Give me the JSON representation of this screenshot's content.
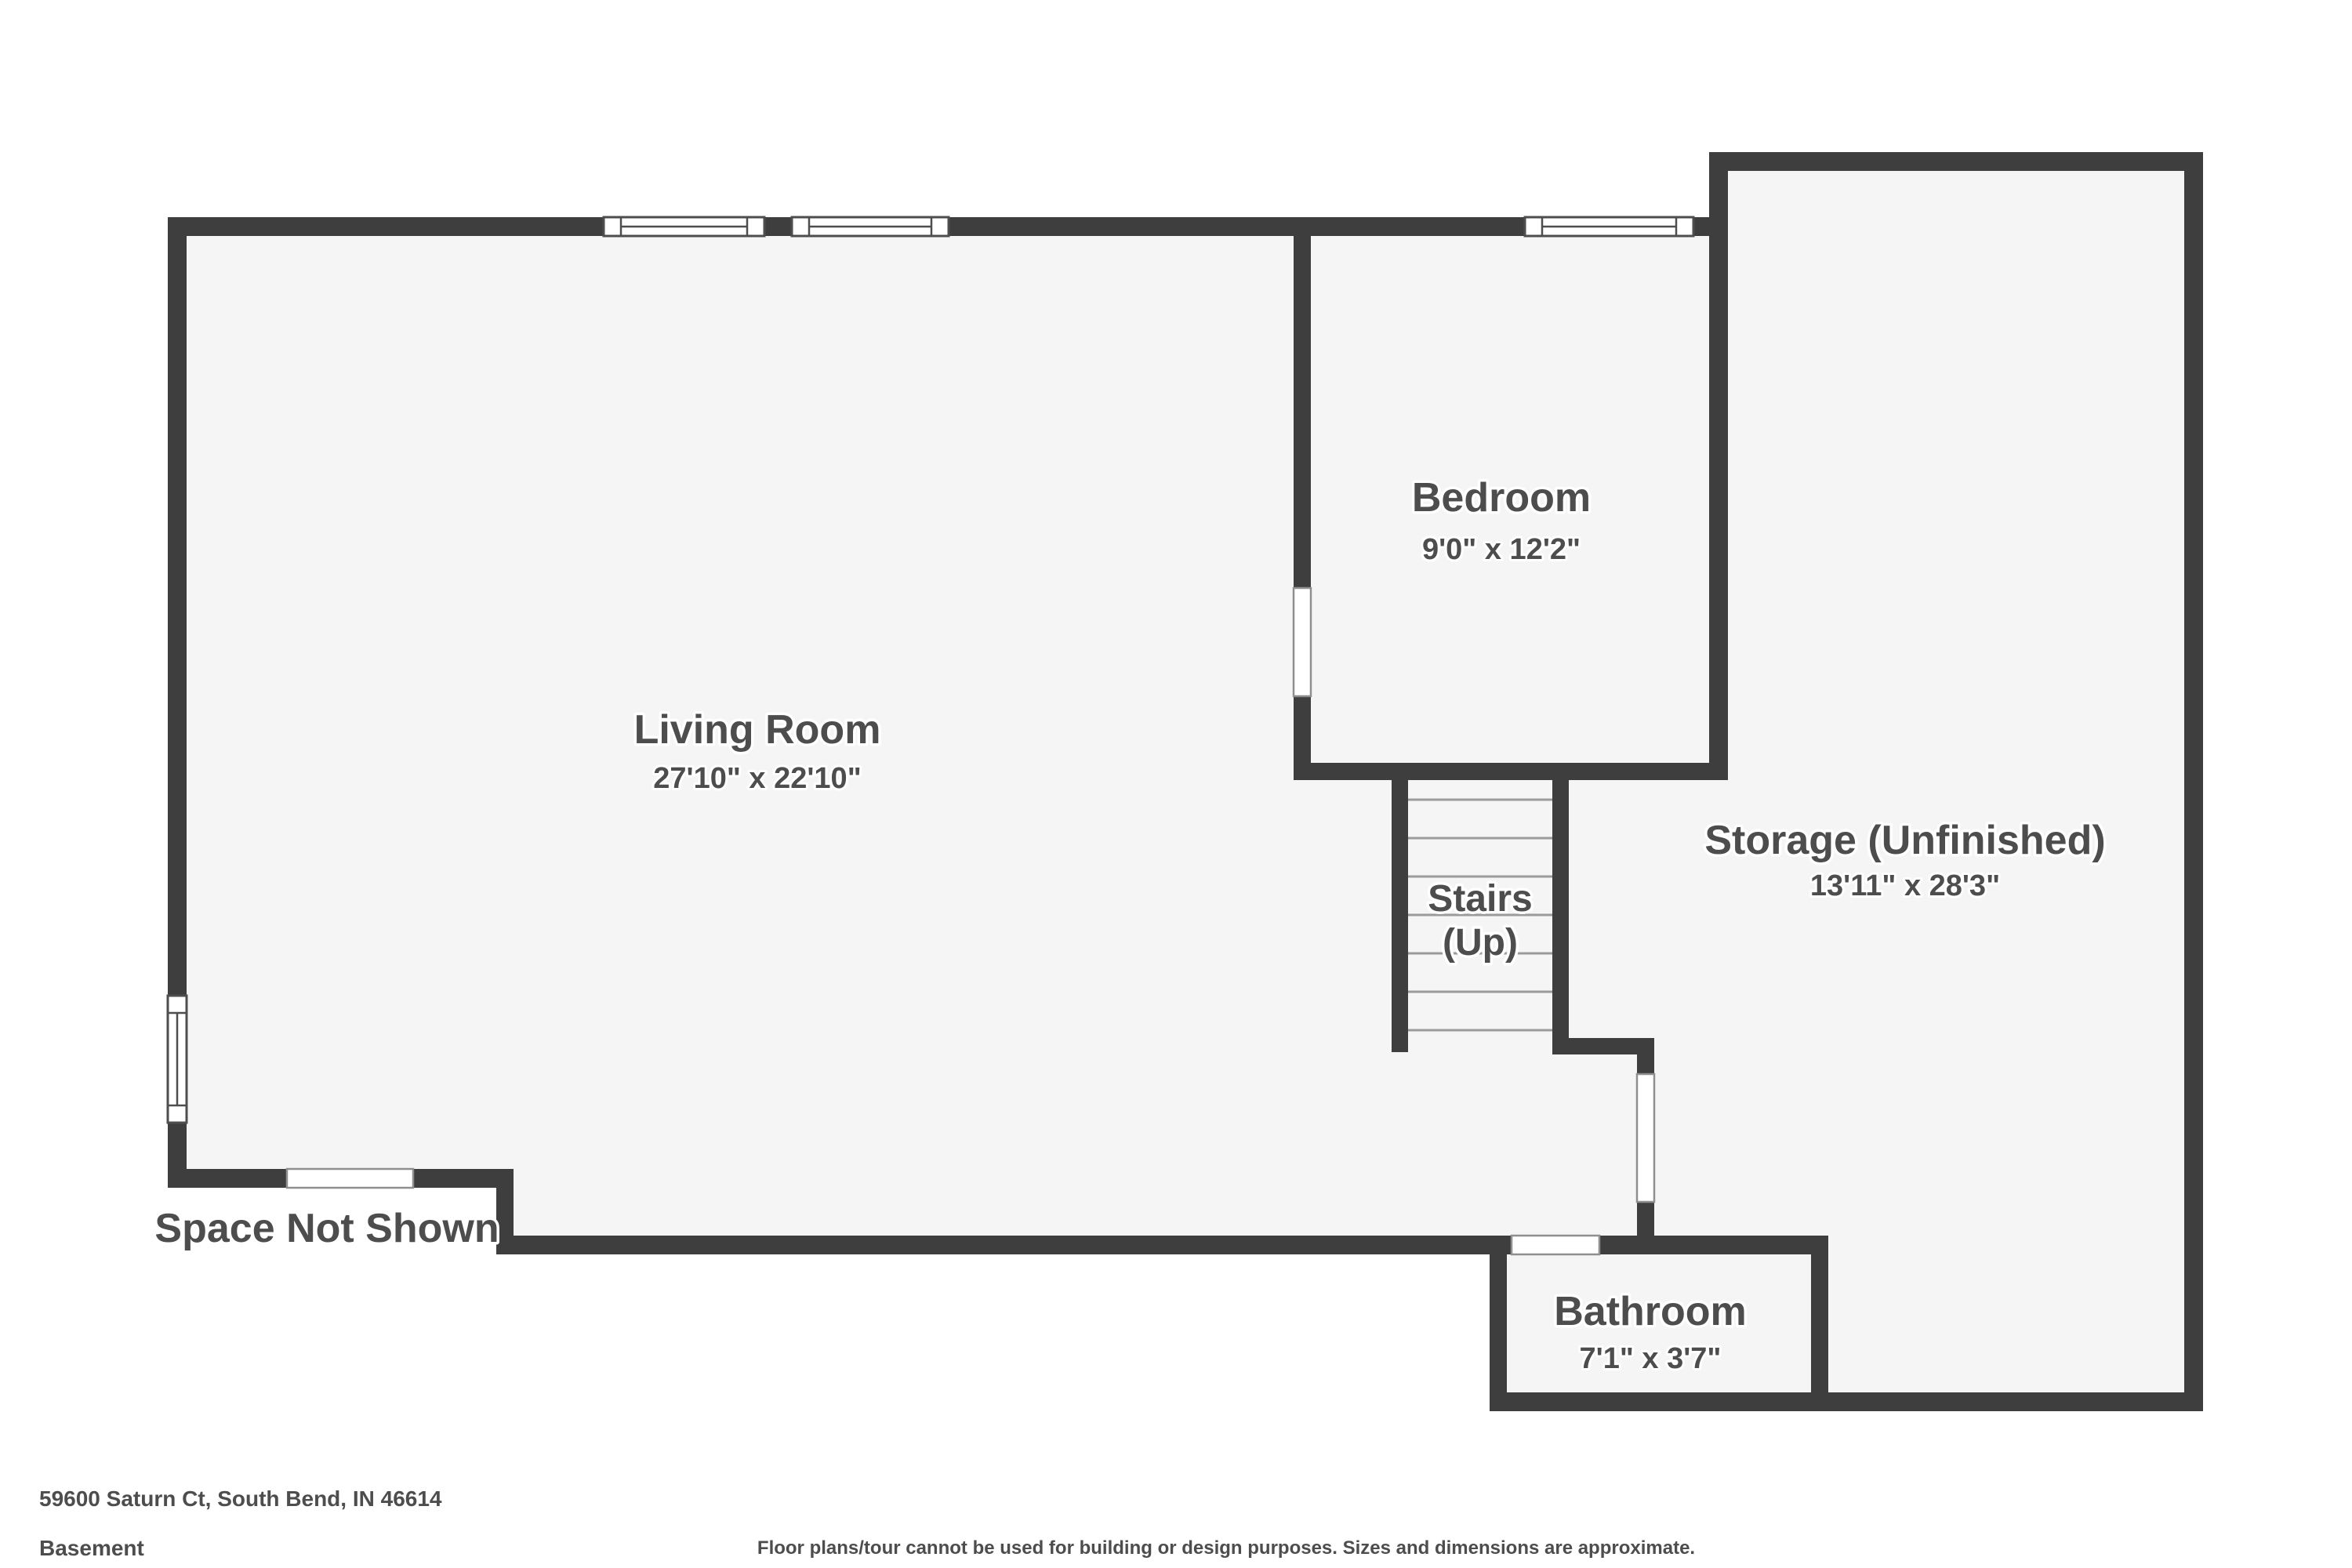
{
  "plan": {
    "rooms": [
      {
        "name": "Living Room",
        "dims": "27'10\" x 22'10\""
      },
      {
        "name": "Bedroom",
        "dims": "9'0\" x 12'2\""
      },
      {
        "name": "Storage (Unfinished)",
        "dims": "13'11\" x 28'3\""
      },
      {
        "name": "Stairs",
        "direction": "(Up)"
      },
      {
        "name": "Bathroom",
        "dims": "7'1\" x 3'7\""
      }
    ],
    "annotations": {
      "space_not_shown": "Space Not Shown"
    }
  },
  "footer": {
    "address": "59600 Saturn Ct, South Bend, IN 46614",
    "level": "Basement",
    "disclaimer": "Floor plans/tour cannot be used for building or design purposes. Sizes and dimensions are approximate."
  },
  "colors": {
    "wall": "#3e3e3e",
    "floor": "#f5f5f5",
    "label_text": "#4d4d4d",
    "stair_tread": "#9b9b9b",
    "opening_outline": "#8f8f8f",
    "background": "#ffffff"
  }
}
